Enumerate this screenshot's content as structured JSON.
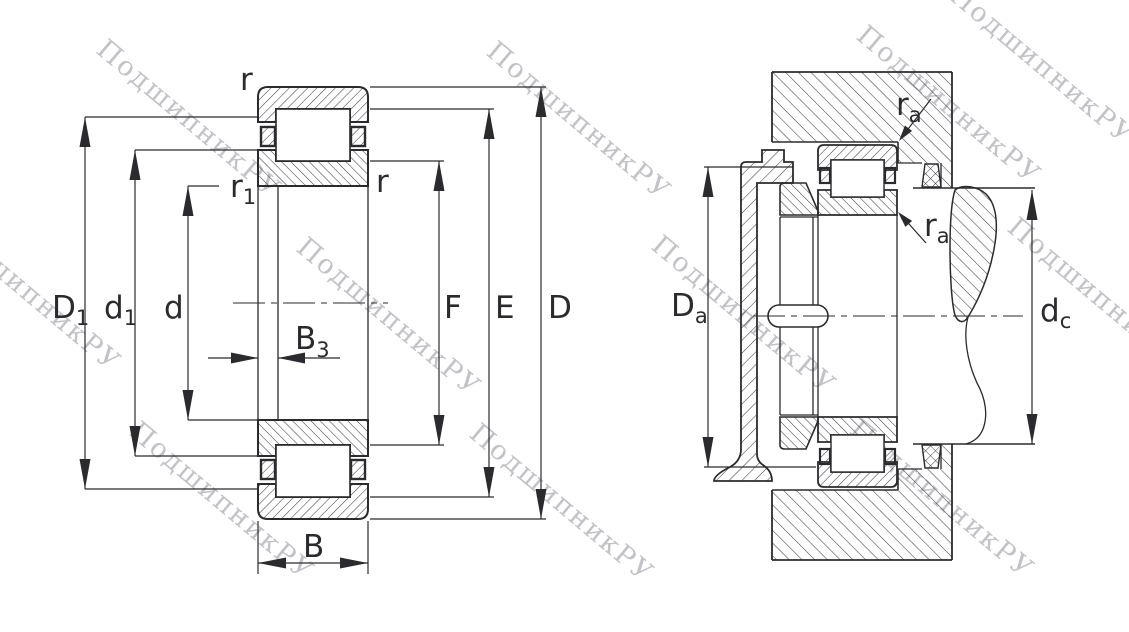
{
  "watermark": {
    "text": "ПодшипникРУ",
    "color": "#c2c3c9"
  },
  "diagram": {
    "line_color": "#2b2b2f",
    "dims": {
      "D1": {
        "main": "D",
        "sub": "1"
      },
      "d1": {
        "main": "d",
        "sub": "1"
      },
      "d": {
        "main": "d",
        "sub": ""
      },
      "B3": {
        "main": "B",
        "sub": "3"
      },
      "B": {
        "main": "B",
        "sub": ""
      },
      "F": {
        "main": "F",
        "sub": ""
      },
      "E": {
        "main": "E",
        "sub": ""
      },
      "D": {
        "main": "D",
        "sub": ""
      },
      "r_top": {
        "main": "r",
        "sub": ""
      },
      "r1": {
        "main": "r",
        "sub": "1"
      },
      "r_side": {
        "main": "r",
        "sub": ""
      },
      "Da": {
        "main": "D",
        "sub": "a"
      },
      "dc": {
        "main": "d",
        "sub": "c"
      },
      "ra_upper": {
        "main": "r",
        "sub": "a"
      },
      "ra_lower": {
        "main": "r",
        "sub": "a"
      }
    }
  }
}
